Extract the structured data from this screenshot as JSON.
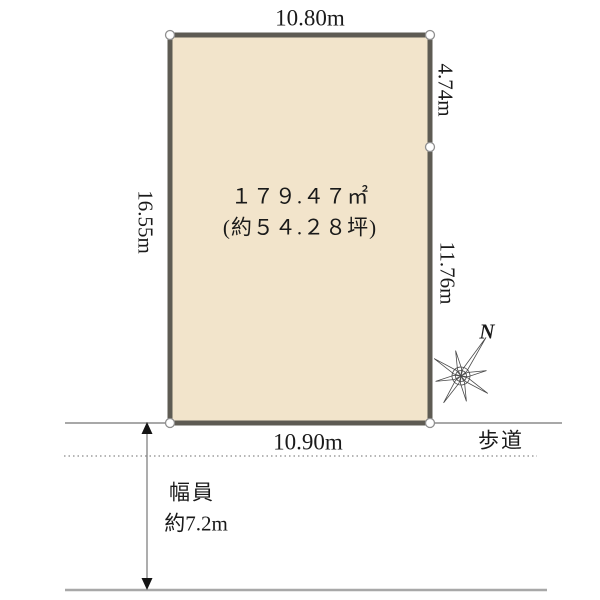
{
  "plot": {
    "area_line1": "１７９.４７㎡",
    "area_line2": "(約５４.２８坪)",
    "dimensions": {
      "top": "10.80m",
      "left": "16.55m",
      "right_upper": "4.74m",
      "right_lower": "11.76m",
      "bottom": "10.90m"
    },
    "colors": {
      "fill": "#f2e4cb",
      "border": "#5e5b53"
    }
  },
  "road": {
    "walkway_label": "歩道",
    "width_label": "幅員",
    "width_value": "約7.2m"
  },
  "compass": {
    "north_label": "N"
  }
}
